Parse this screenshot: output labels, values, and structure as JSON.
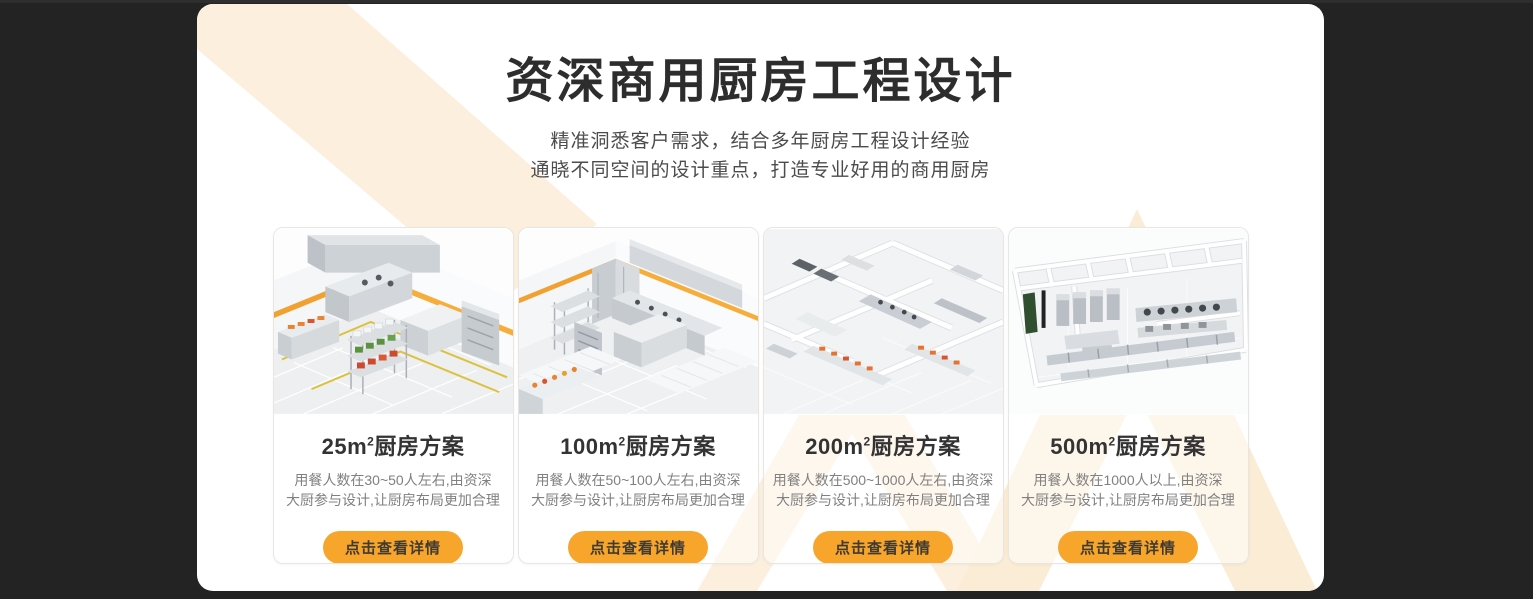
{
  "header": {
    "title": "资深商用厨房工程设计",
    "subtitle_line1": "精准洞悉客户需求，结合多年厨房工程设计经验",
    "subtitle_line2": "通晓不同空间的设计重点，打造专业好用的商用厨房"
  },
  "cards": [
    {
      "area": "25m",
      "sup": "2",
      "suffix": "厨房方案",
      "desc_line1": "用餐人数在30~50人左右,由资深",
      "desc_line2": "大厨参与设计,让厨房布局更加合理",
      "cta": "点击查看详情"
    },
    {
      "area": "100m",
      "sup": "2",
      "suffix": "厨房方案",
      "desc_line1": "用餐人数在50~100人左右,由资深",
      "desc_line2": "大厨参与设计,让厨房布局更加合理",
      "cta": "点击查看详情"
    },
    {
      "area": "200m",
      "sup": "2",
      "suffix": "厨房方案",
      "desc_line1": "用餐人数在500~1000人左右,由资深",
      "desc_line2": "大厨参与设计,让厨房布局更加合理",
      "cta": "点击查看详情"
    },
    {
      "area": "500m",
      "sup": "2",
      "suffix": "厨房方案",
      "desc_line1": "用餐人数在1000人以上,由资深",
      "desc_line2": "大厨参与设计,让厨房布局更加合理",
      "cta": "点击查看详情"
    }
  ],
  "colors": {
    "page_background": "#232323",
    "panel_background": "#ffffff",
    "pattern_cream": "#fcefdd",
    "accent_orange": "#f8a52b",
    "title_text": "#2d2d2d",
    "desc_text": "#808080"
  }
}
